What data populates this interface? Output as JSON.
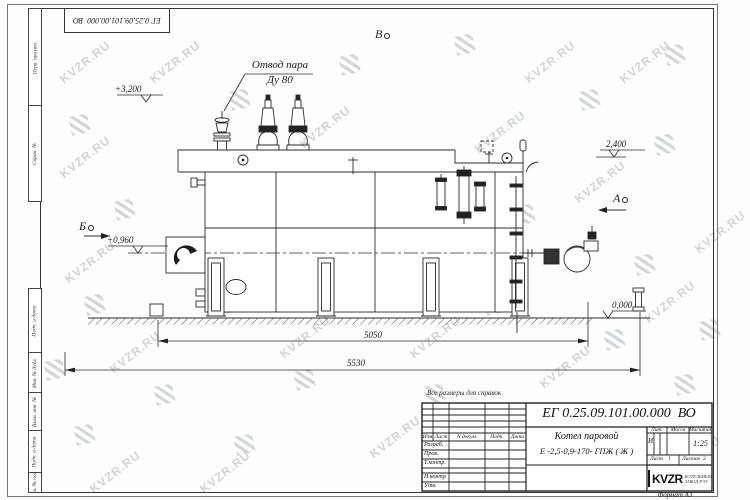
{
  "watermark": {
    "text": "KVZR.RU"
  },
  "stamp_top": {
    "doc_number": "ЕГ 0.25.09.101.00.000  ВО"
  },
  "margin_labels": {
    "perv_primen": "Перв. примен.",
    "sprav_no": "Справ. №",
    "podp_data_1": "Подп. и дата",
    "inv_dubl": "Инв. № дубл.",
    "vzam_inv": "Взам. инв. №",
    "podp_data_2": "Подп. и дата",
    "inv_podl": "Инв. № подл."
  },
  "drawing": {
    "callout_line1": "Отвод пара",
    "callout_line2": "Ду 80",
    "elevations": {
      "e1": "+3,200",
      "e2": "2,400",
      "e3": "+0,960",
      "e4": "0,000"
    },
    "dimensions": {
      "d1": "5050",
      "d2": "5530"
    },
    "views": {
      "a": "А",
      "b": "Б",
      "v": "В"
    }
  },
  "note": "Все размеры для справок",
  "title_block": {
    "doc_number": "ЕГ 0.25.09.101.00.000  ВО",
    "name_line1": "Котел паровой",
    "name_line2": "Е -2,5-0,9-170- ГПЖ ( Ж )",
    "header": {
      "izm": "Изм",
      "list": "Лист",
      "ndokum": "N докум.",
      "podp": "Подп.",
      "data": "Дата"
    },
    "rows": {
      "razrab": "Разраб.",
      "prov": "Пров.",
      "tkontr": "Т.контр.",
      "nkontr": "Н.контр",
      "utv": "Утв."
    },
    "right": {
      "lit_label": "Лит.",
      "massa_label": "Масса",
      "masshtab_label": "Масштаб",
      "lit_value": "И",
      "masshtab_value": "1:25",
      "list_label": "Лист",
      "list_value": "1",
      "listov_label": "Листов",
      "listov_value": "2"
    },
    "company": {
      "logo_text": "KVZR",
      "sub_line1": "КОТЕЛЬНЫЙ",
      "sub_line2": "ЗАВОД РЭУ"
    },
    "format_label": "Формат А3"
  }
}
